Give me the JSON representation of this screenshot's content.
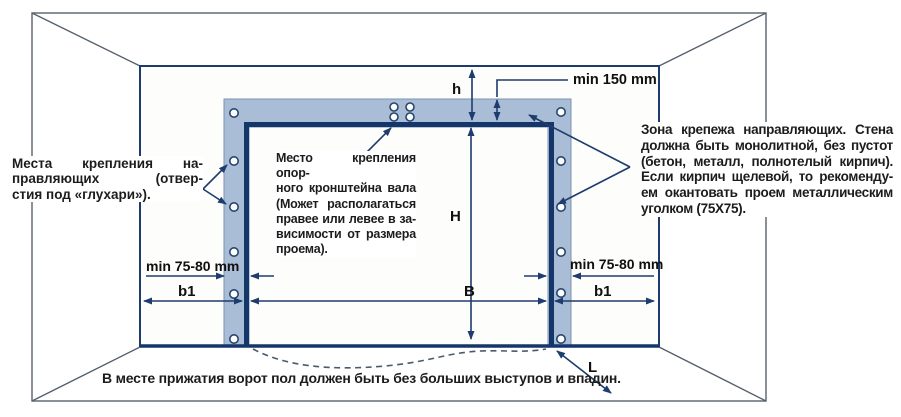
{
  "notes": {
    "left": {
      "lines": [
        "Места крепления на-",
        "правляющих (отвер-",
        "стия под «глухари»)."
      ]
    },
    "center": {
      "lines": [
        "Место крепления опор-",
        "ного кронштейна вала",
        "(Может располагаться",
        "правее или левее в за-",
        "висимости от размера",
        "проема)."
      ]
    },
    "right": {
      "lines": [
        "Зона крепежа направляющих. Стена",
        "должна быть монолитной, без пустот",
        "(бетон, металл, полнотелый кирпич).",
        "Если кирпич щелевой, то рекоменду-",
        "ем окантовать проем металлическим",
        "уголком (75X75)."
      ]
    },
    "bottom": "В месте прижатия ворот пол должен быть без больших выступов и впадин."
  },
  "dimensions": {
    "h": "h",
    "H": "H",
    "B": "B",
    "b1_left": "b1",
    "b1_right": "b1",
    "min_lintel": "min 150 mm",
    "min_side_left": "min 75-80 mm",
    "min_side_right": "min 75-80 mm",
    "L": "L"
  },
  "colors": {
    "frame_navy": "#1b3a6e",
    "mounting_band": "#a9bdd6",
    "band_edge": "#7d93af",
    "wall_line": "#55606e",
    "text": "#1c1c1c"
  }
}
